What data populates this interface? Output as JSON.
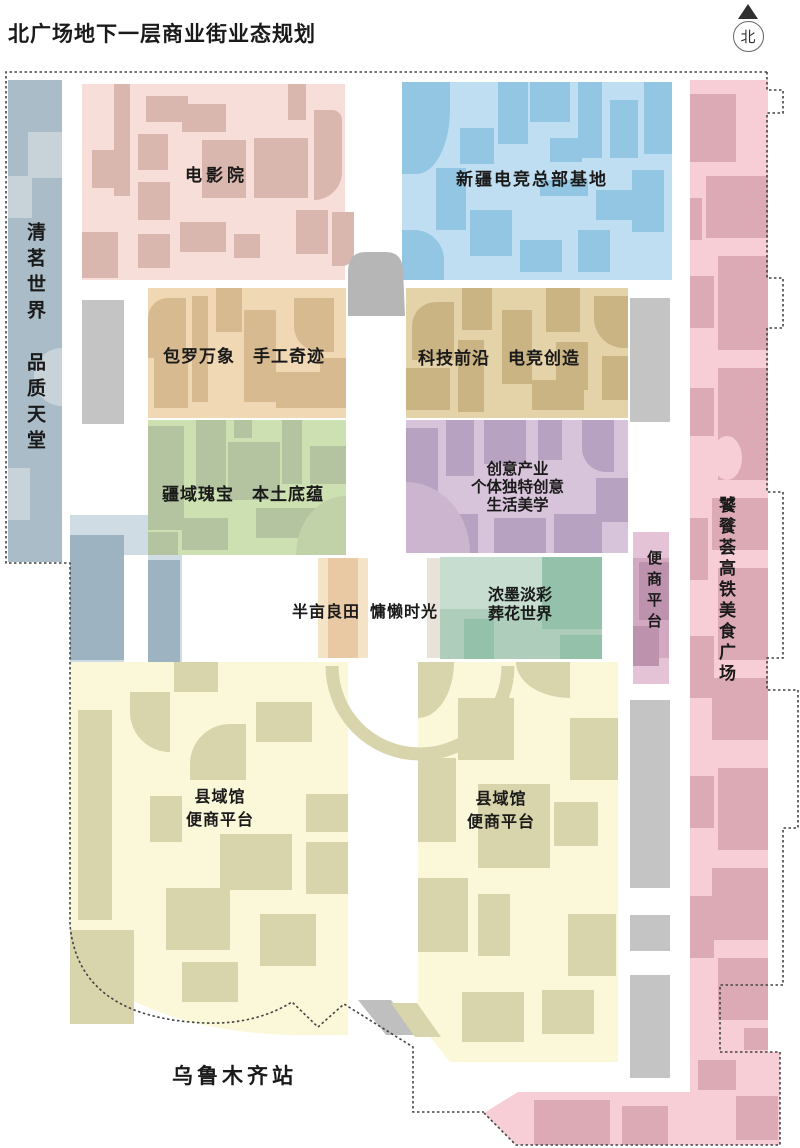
{
  "title": "北广场地下一层商业街业态规划",
  "compass": {
    "label": "北"
  },
  "station": {
    "label": "乌鲁木齐站"
  },
  "zones": {
    "tea": {
      "line1": "清茗世界",
      "line2": "品质天堂",
      "color": "#a9bcc7"
    },
    "cinema": {
      "label": "电影院",
      "color": "#f8ded8"
    },
    "esports": {
      "label": "新疆电竞总部基地",
      "color": "#c0def1"
    },
    "handicraft": {
      "part1": "包罗万象",
      "part2": "手工奇迹",
      "color": "#f1d8b4"
    },
    "tech": {
      "part1": "科技前沿",
      "part2": "电竞创造",
      "color": "#e4d2a9"
    },
    "local": {
      "part1": "疆域瑰宝",
      "part2": "本土底蕴",
      "color": "#cde0b2"
    },
    "creative": {
      "lines": [
        "创意产业",
        "个体独特创意",
        "生活美学"
      ],
      "color": "#d8c4da"
    },
    "leisure": {
      "part1": "半亩良田",
      "part2": "慵懒时光",
      "color": "#e8c9a4"
    },
    "ink": {
      "line1": "浓墨淡彩",
      "line2": "葬花世界",
      "color": "#aecdbb"
    },
    "convenience_strip": {
      "label": "便商平台",
      "color": "#d3a8c1"
    },
    "food_plaza": {
      "label": "饕餮荟高铁美食广场",
      "color": "#f7ced5"
    },
    "county_left": {
      "line1": "县域馆",
      "line2": "便商平台",
      "color": "#fbf8d9"
    },
    "county_right": {
      "line1": "县域馆",
      "line2": "便商平台",
      "color": "#fbf8d9"
    }
  },
  "colors": {
    "corridor_gray": "#c5c4c4",
    "boundary": "#444444",
    "background": "#ffffff"
  }
}
